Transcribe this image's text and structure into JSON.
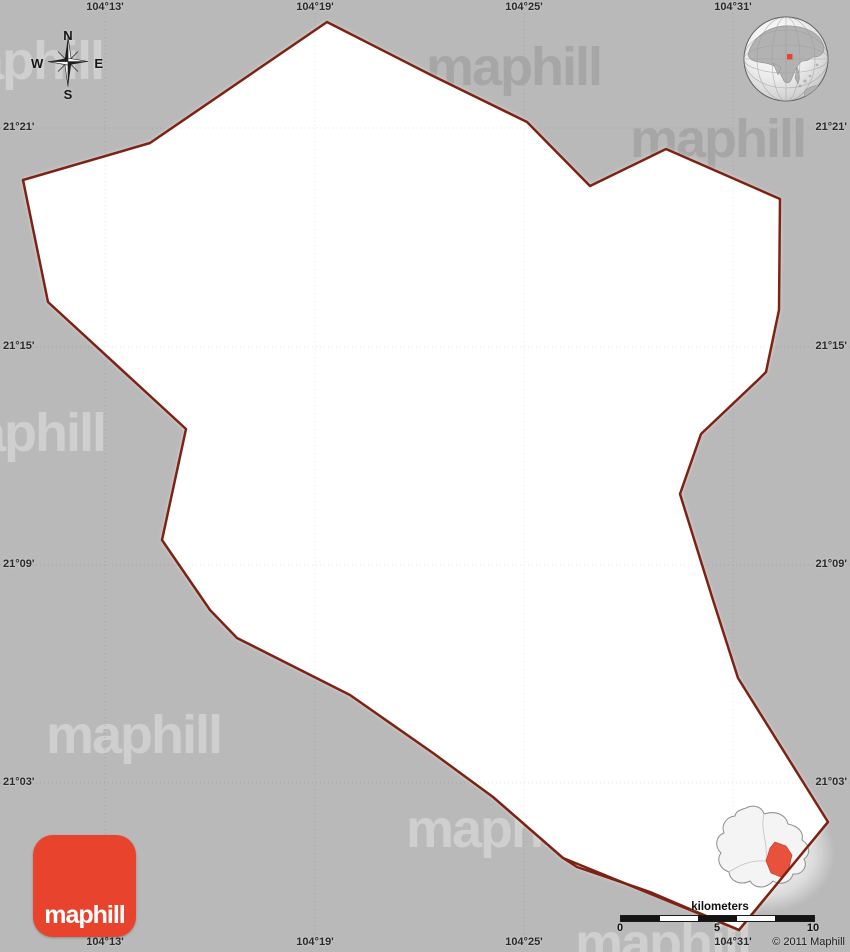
{
  "canvas": {
    "width": 850,
    "height": 952,
    "background": "#b9b9b9"
  },
  "watermark": {
    "text": "maphill",
    "items": [
      {
        "x": -72,
        "y": 34,
        "variant": "light"
      },
      {
        "x": 426,
        "y": 40,
        "variant": "dark"
      },
      {
        "x": 630,
        "y": 112,
        "variant": "dark"
      },
      {
        "x": -70,
        "y": 406,
        "variant": "light"
      },
      {
        "x": 46,
        "y": 708,
        "variant": "light"
      },
      {
        "x": 406,
        "y": 802,
        "variant": "light"
      },
      {
        "x": 575,
        "y": 916,
        "variant": "light"
      }
    ]
  },
  "map": {
    "region_fill": "#ffffff",
    "border_color": "#7e2213",
    "border_width": 2.5,
    "outline_points": [
      [
        327,
        22
      ],
      [
        433,
        76
      ],
      [
        527,
        122
      ],
      [
        590,
        186
      ],
      [
        666,
        149
      ],
      [
        780,
        199
      ],
      [
        779,
        310
      ],
      [
        766,
        372
      ],
      [
        759,
        379
      ],
      [
        701,
        434
      ],
      [
        680,
        494
      ],
      [
        713,
        600
      ],
      [
        738,
        678
      ],
      [
        828,
        822
      ],
      [
        739,
        930
      ],
      [
        650,
        892
      ],
      [
        577,
        867
      ],
      [
        563,
        858
      ],
      [
        493,
        797
      ],
      [
        433,
        753
      ],
      [
        350,
        695
      ],
      [
        237,
        638
      ],
      [
        210,
        610
      ],
      [
        162,
        540
      ],
      [
        186,
        429
      ],
      [
        48,
        302
      ],
      [
        23,
        180
      ],
      [
        150,
        143
      ]
    ],
    "tip_overlay_points": [
      [
        563,
        858
      ],
      [
        739,
        930
      ],
      [
        828,
        822
      ]
    ]
  },
  "grid": {
    "under_color": "#a4a4a4",
    "over_color": "#e7e7e7",
    "vertical": [
      {
        "label": "104°13'",
        "x": 105
      },
      {
        "label": "104°19'",
        "x": 315
      },
      {
        "label": "104°25'",
        "x": 524
      },
      {
        "label": "104°31'",
        "x": 733
      }
    ],
    "horizontal": [
      {
        "label": "21°21'",
        "y": 128
      },
      {
        "label": "21°15'",
        "y": 347
      },
      {
        "label": "21°09'",
        "y": 565
      },
      {
        "label": "21°03'",
        "y": 783
      }
    ]
  },
  "compass": {
    "n": "N",
    "e": "E",
    "s": "S",
    "w": "W"
  },
  "locator": {
    "marker_color": "#e8432d"
  },
  "inset": {
    "outer_fill": "#f4f4f4",
    "outer_stroke": "#8f8f8f",
    "red_fill": "#e8513c",
    "outer_path": "M91,38 C99,34 107,37 109,44 C121,40 131,45 133,54 C143,56 149,62 147,70 C155,75 156,84 149,89 C153,97 147,105 138,104 C136,112 126,116 118,111 C111,119 100,119 95,111 C85,116 75,111 74,102 C65,99 61,90 66,83 C59,76 61,66 69,63 C66,55 71,47 80,46 C81,41 85,40 91,38 Z",
    "red_path": "M120,72 L131,76 L137,85 L134,98 L126,107 L116,103 L111,91 L115,78 Z",
    "inner_lines": [
      "M74,102 C85,95 95,90 111,91",
      "M109,44 C105,60 113,70 111,91"
    ]
  },
  "scale": {
    "title": "kilometers",
    "title_x": 720,
    "bar_colors": [
      "#141414",
      "#ffffff",
      "#141414",
      "#ffffff",
      "#141414"
    ],
    "ticks": [
      {
        "label": "0",
        "x": 620
      },
      {
        "label": "5",
        "x": 717
      },
      {
        "label": "10",
        "x": 813
      }
    ]
  },
  "copyright": "© 2011 Maphill",
  "logo": {
    "text": "maphill",
    "color": "#e8432d"
  }
}
